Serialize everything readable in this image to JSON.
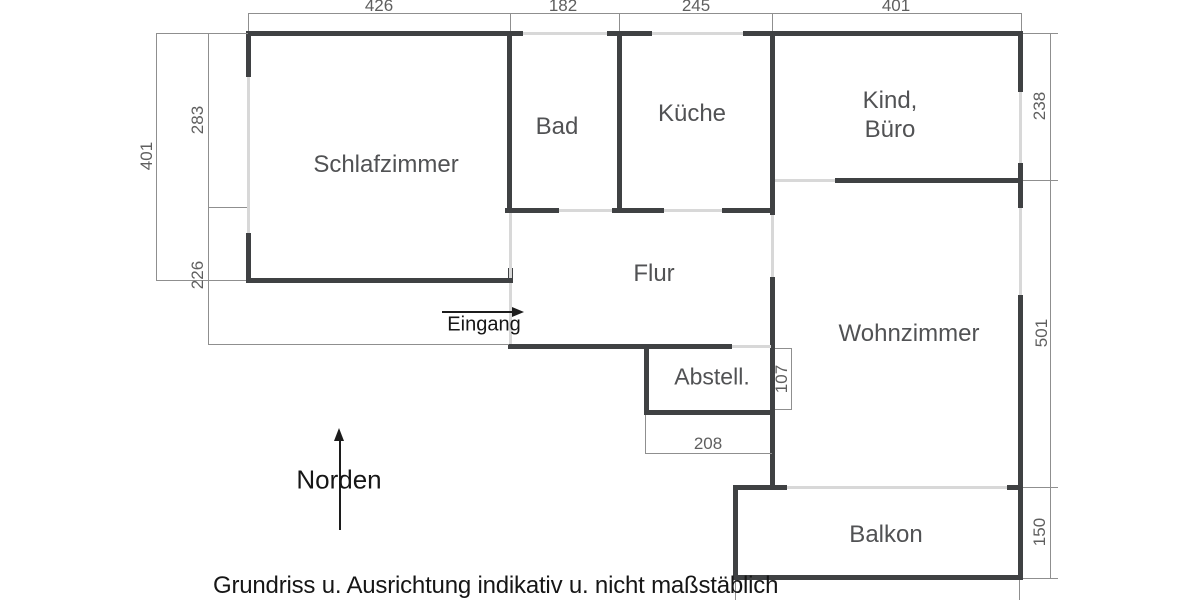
{
  "note": "Grundriss u. Ausrichtung indikativ u. nicht maßstäblich",
  "compass": {
    "label": "Norden"
  },
  "entrance": {
    "label": "Eingang"
  },
  "rooms": {
    "schlafzimmer": {
      "label": "Schlafzimmer"
    },
    "bad": {
      "label": "Bad"
    },
    "kueche": {
      "label": "Küche"
    },
    "kind_buero": {
      "line1": "Kind,",
      "line2": "Büro"
    },
    "flur": {
      "label": "Flur"
    },
    "abstell": {
      "label": "Abstell."
    },
    "wohnzimmer": {
      "label": "Wohnzimmer"
    },
    "balkon": {
      "label": "Balkon"
    }
  },
  "dimensions_cm": {
    "top": {
      "schlafzimmer": "426",
      "bad": "182",
      "kueche": "245",
      "kind_buero": "401"
    },
    "left": {
      "total": "401",
      "upper": "283",
      "lower": "226"
    },
    "right": {
      "kind_buero": "238",
      "wohnzimmer": "501",
      "balkon": "150"
    },
    "abstell": {
      "depth": "107",
      "width": "208"
    }
  },
  "colors": {
    "wall": "#3f4143",
    "opening": "#d8d8d8",
    "dimension_line": "#8f8f8f",
    "dimension_text": "#5f5f5f",
    "room_text": "#515254",
    "annotation_text": "#161616",
    "background": "#ffffff"
  }
}
